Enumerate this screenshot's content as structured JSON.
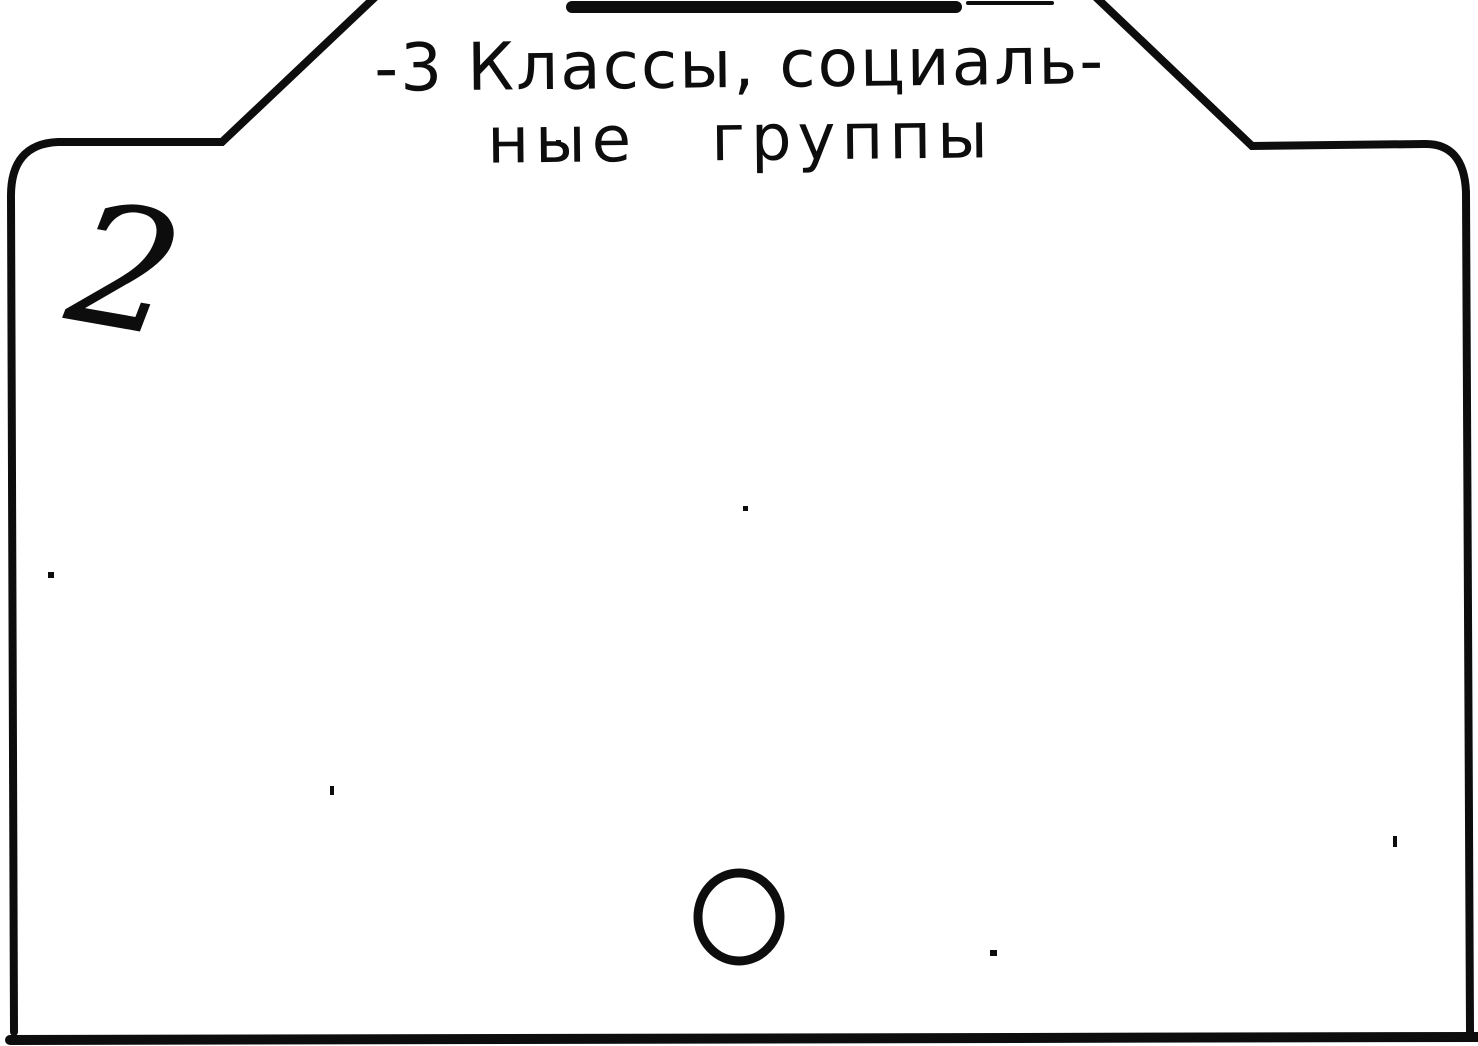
{
  "card": {
    "tab": {
      "heading_line1": "-3 Классы, социаль-",
      "heading_line2": "ные группы"
    },
    "number": "2",
    "marks": {
      "punch_hole": "circle-outline-mark"
    },
    "colors": {
      "ink": "#0d0d0d",
      "paper": "#ffffff"
    }
  }
}
